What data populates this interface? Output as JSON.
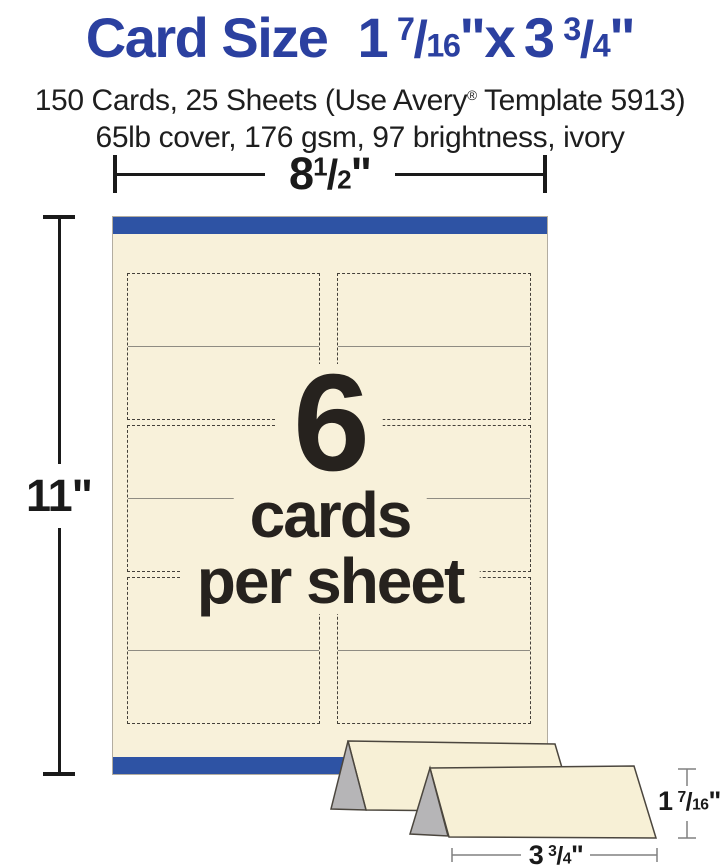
{
  "header": {
    "title_main": "Card Size",
    "size": {
      "w_whole": "1",
      "w_num": "7",
      "w_den": "16",
      "w_unit": "\"",
      "times": "x",
      "h_whole": "3",
      "h_num": "3",
      "h_den": "4",
      "h_unit": "\"",
      "slash": "/"
    },
    "subtitle_pre": "150 Cards, 25 Sheets (Use Avery",
    "subtitle_reg": "®",
    "subtitle_post": " Template 5913)",
    "spec_line": "65lb cover, 176 gsm, 97 brightness, ivory"
  },
  "diagram": {
    "sheet_width": {
      "whole": "8",
      "num": "1",
      "den": "2",
      "unit": "\"",
      "slash": "/"
    },
    "sheet_height": "11\"",
    "center_count": "6",
    "center_line1": "cards",
    "center_line2": "per sheet",
    "grid": {
      "rows": 3,
      "cols": 2,
      "cards_per_sheet": 6
    }
  },
  "tent": {
    "height": {
      "whole": "1",
      "num": "7",
      "den": "16",
      "unit": "\"",
      "slash": "/"
    },
    "width": {
      "whole": "3",
      "num": "3",
      "den": "4",
      "unit": "\"",
      "slash": "/"
    }
  },
  "colors": {
    "title_blue": "#2b40a0",
    "band_blue": "#2e53a4",
    "sheet_ivory": "#f8f1da",
    "tent_ivory": "#f7f0d6",
    "triangle_gray": "#b6b5b7",
    "ink": "#231f20",
    "fold_gray": "#8f8c82",
    "dim_gray": "#808080"
  }
}
